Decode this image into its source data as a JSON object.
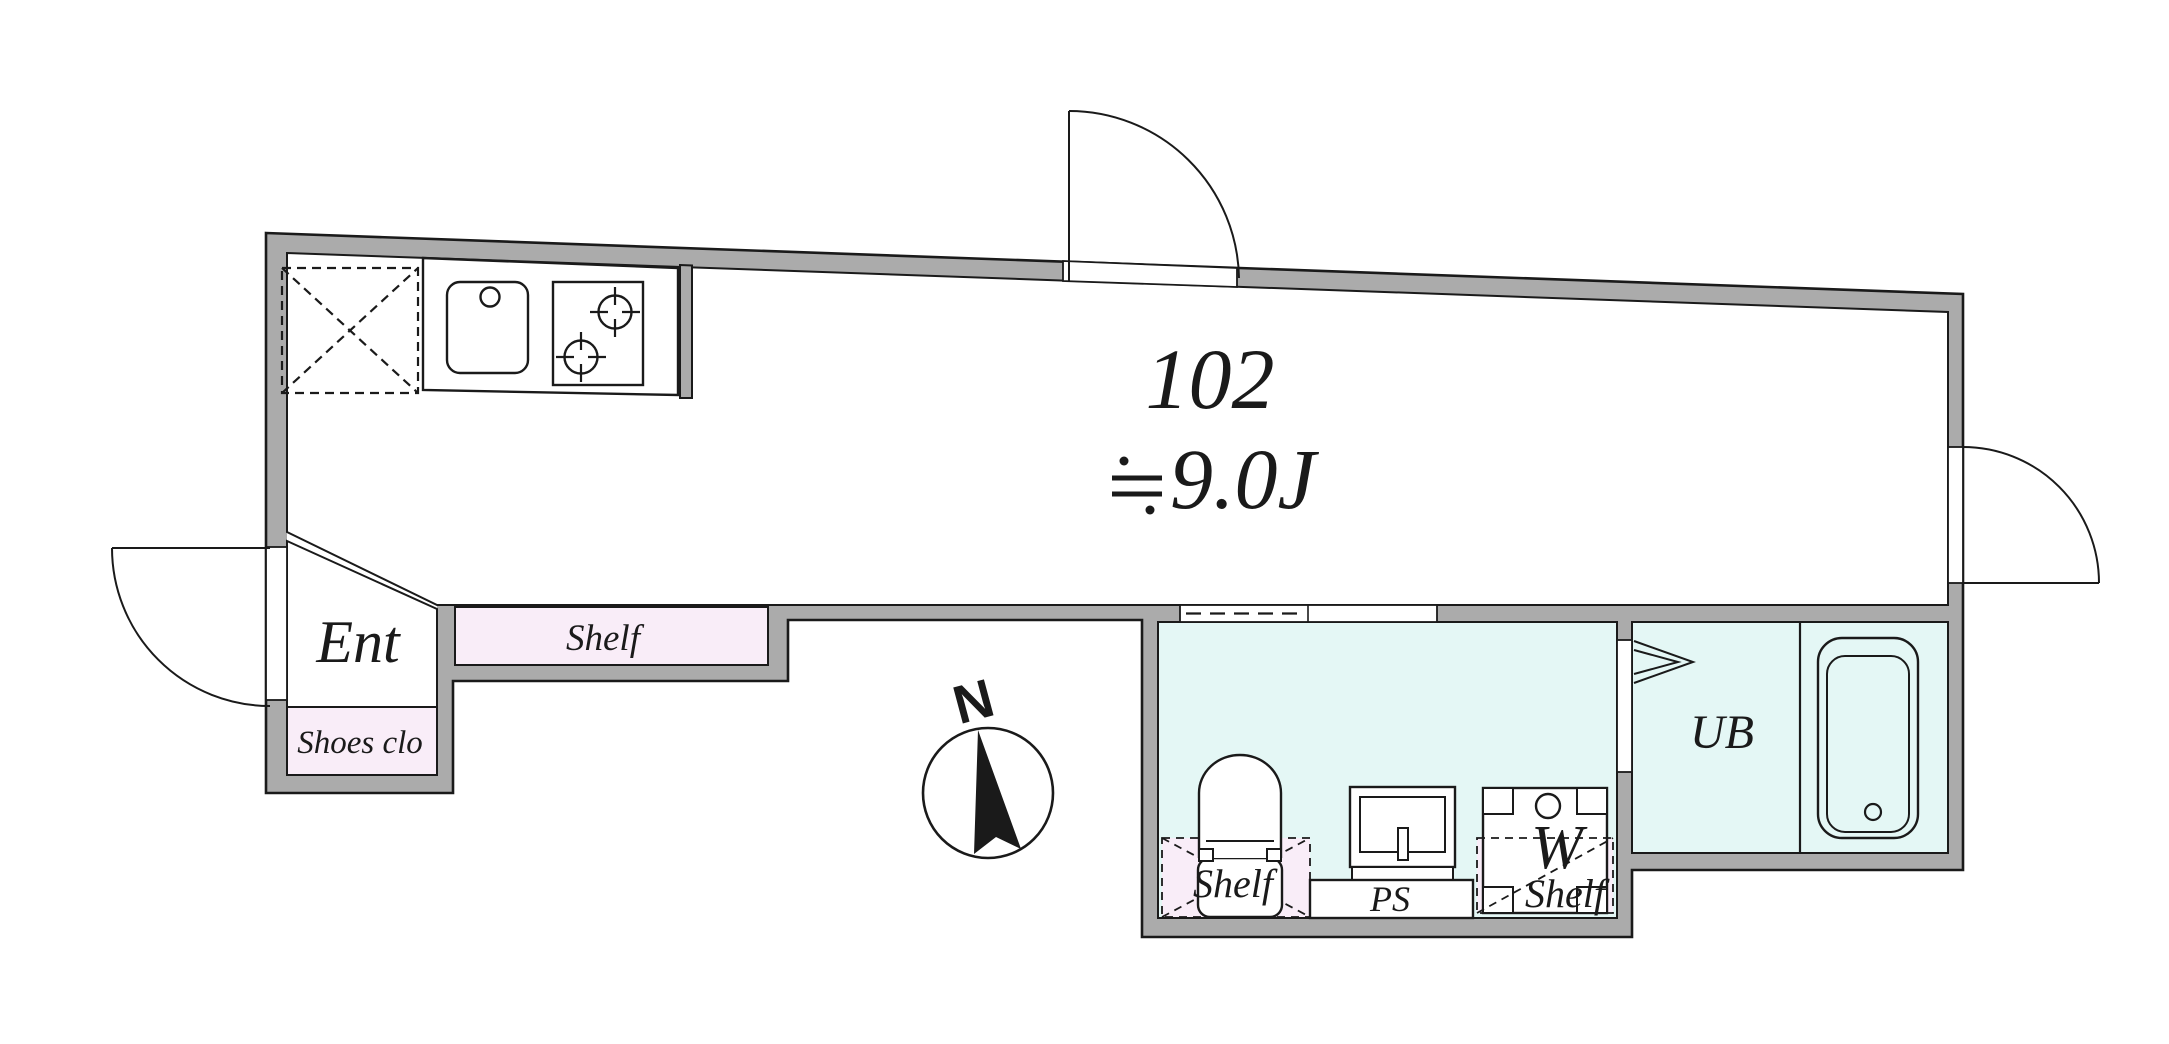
{
  "plan": {
    "unit_number": "102",
    "area_label": "≒9.0J",
    "area_number": "9.0J",
    "compass_label": "N",
    "rooms": {
      "entrance": {
        "label": "Ent"
      },
      "shoes_closet": {
        "label": "Shoes clo"
      },
      "entry_shelf": {
        "label": "Shelf"
      },
      "toilet_shelf": {
        "label": "Shelf"
      },
      "washer": {
        "label": "W"
      },
      "washer_shelf": {
        "label": "Shelf"
      },
      "pipe_space": {
        "label": "PS"
      },
      "unit_bath": {
        "label": "UB"
      }
    }
  },
  "colors": {
    "wall": "#ABABAB",
    "closet_fill": "#F9EDF8",
    "wet_area_fill": "#E4F7F5",
    "floor_fill": "#FFFFFF",
    "line": "#1A1A1A"
  }
}
